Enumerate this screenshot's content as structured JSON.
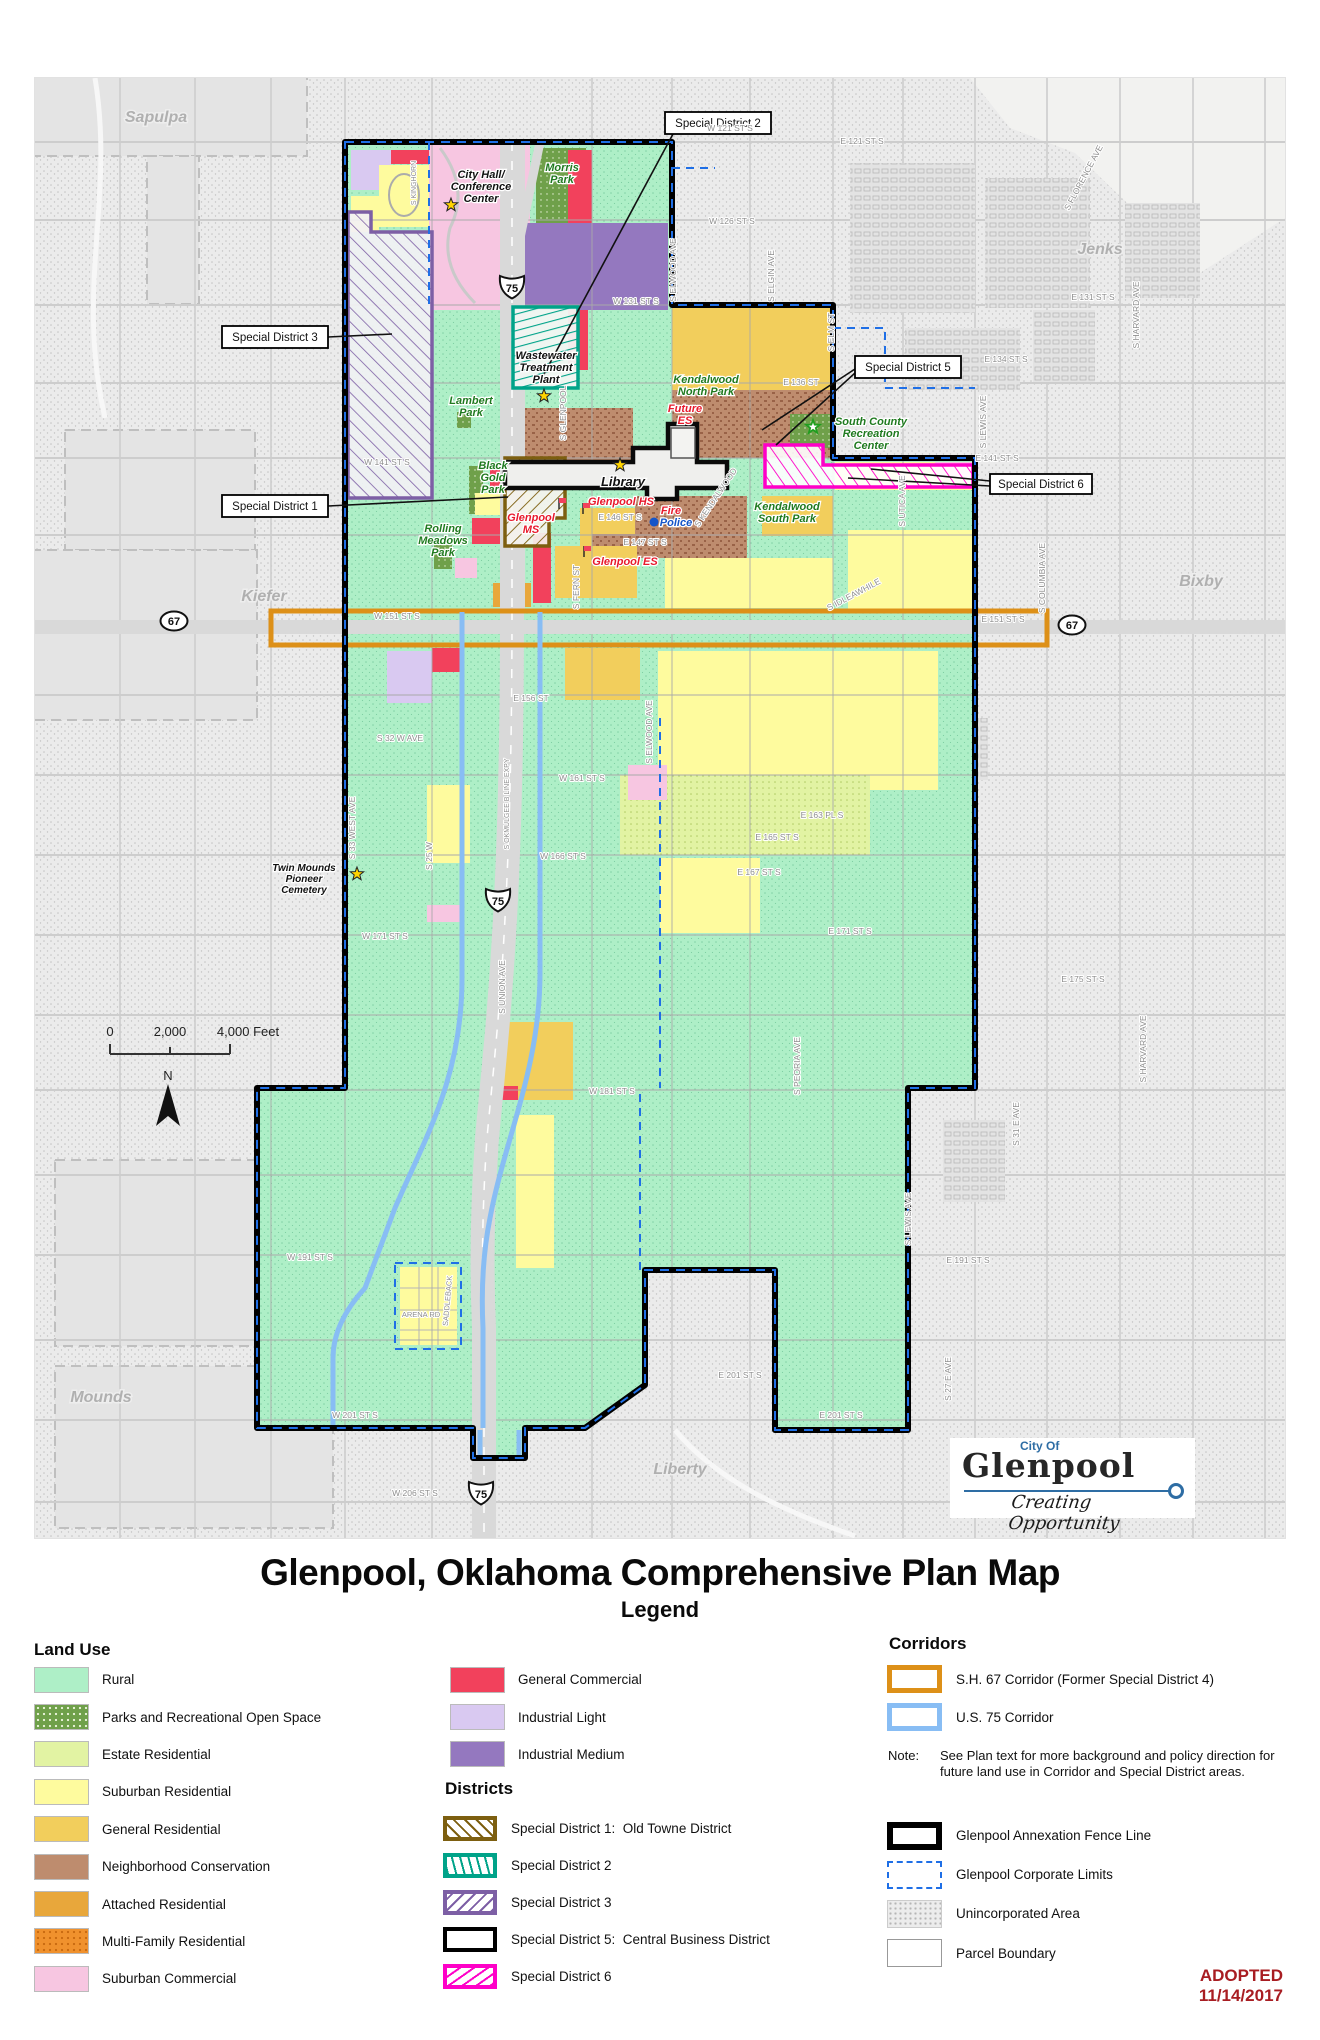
{
  "title": "Glenpool, Oklahoma Comprehensive Plan Map",
  "legend_title": "Legend",
  "adopted": {
    "line1": "ADOPTED",
    "line2": "11/14/2017"
  },
  "logo": {
    "city_of": "City Of",
    "name": "Glenpool",
    "tagline": "Creating Opportunity"
  },
  "palette": {
    "mint": "#aeefc7",
    "mintdot": "#7ecfa3",
    "parks": "#6fa04a",
    "estate": "#e2f3a3",
    "estatedot": "#aec962",
    "subres": "#fefb9e",
    "genres": "#f2ce5c",
    "nconv": "#be8c6e",
    "nconvdot": "#996247",
    "attres": "#e8a73b",
    "multi": "#f0912d",
    "subcom": "#f7c6e1",
    "gencom": "#f2415c",
    "indl": "#d9c9f1",
    "indm": "#9478bf",
    "c67": "#dd9018",
    "c75": "#88bdf4",
    "corp": "#1f6fe6",
    "sd1": "#7d5f10",
    "sd2": "#00a389",
    "sd3": "#7d5fa5",
    "sd6": "#ff00c8",
    "graybg": "#ebebeb",
    "stip": "#c2c2c2",
    "plain": "#e4e4e4",
    "road": "#d9d9d9",
    "parktext": "#1f7a1f",
    "schooltext": "#e8192c",
    "policeblue": "#1555c8",
    "adopted": "#a81d22",
    "star": "#ffd400",
    "greenstar": "#1f9e1f",
    "logoblue": "#2e6da4"
  },
  "legend": {
    "land_use": {
      "heading": "Land Use",
      "items": [
        {
          "label": "Rural",
          "color": "#aeefc7"
        },
        {
          "label": "Parks and Recreational Open Space",
          "color": "#6fa04a",
          "dots": "#e8f2d8"
        },
        {
          "label": "Estate Residential",
          "color": "#e2f3a3"
        },
        {
          "label": "Suburban Residential",
          "color": "#fefb9e"
        },
        {
          "label": "General Residential",
          "color": "#f2ce5c"
        },
        {
          "label": "Neighborhood Conservation",
          "color": "#be8c6e"
        },
        {
          "label": "Attached Residential",
          "color": "#e8a73b"
        },
        {
          "label": "Multi-Family Residential",
          "color": "#f0912d",
          "dots": "#c96a10"
        },
        {
          "label": "Suburban Commercial",
          "color": "#f7c6e1"
        }
      ]
    },
    "col2": [
      {
        "label": "General Commercial",
        "color": "#f2415c"
      },
      {
        "label": "Industrial Light",
        "color": "#d9c9f1"
      },
      {
        "label": "Industrial Medium",
        "color": "#9478bf"
      }
    ],
    "districts": {
      "heading": "Districts",
      "items": [
        {
          "label": "Special District 1:  Old Towne District",
          "color": "#7d5f10",
          "angle": 45
        },
        {
          "label": "Special District 2",
          "color": "#00a389",
          "angle": 75
        },
        {
          "label": "Special District 3",
          "color": "#7d5fa5",
          "angle": -45
        },
        {
          "label": "Special District 5:  Central Business District",
          "color": "#000000",
          "angle": null
        },
        {
          "label": "Special District 6",
          "color": "#ff00c8",
          "angle": -35
        }
      ]
    },
    "corridors": {
      "heading": "Corridors",
      "items": [
        {
          "label": "S.H. 67 Corridor (Former Special District 4)",
          "color": "#dd9018"
        },
        {
          "label": "U.S. 75 Corridor",
          "color": "#88bdf4"
        }
      ]
    },
    "note": {
      "label": "Note:",
      "text": "See Plan text for more background and policy direction for future land use in Corridor and Special District areas."
    },
    "boundaries": [
      {
        "label": "Glenpool Annexation Fence Line",
        "kind": "annex"
      },
      {
        "label": "Glenpool Corporate Limits",
        "kind": "corp"
      },
      {
        "label": "Unincorporated Area",
        "kind": "uninc"
      },
      {
        "label": "Parcel Boundary",
        "kind": "parcel"
      }
    ]
  },
  "map": {
    "cities": [
      {
        "t": "Sapulpa",
        "x": 121,
        "y": 44
      },
      {
        "t": "Jenks",
        "x": 1065,
        "y": 176
      },
      {
        "t": "Bixby",
        "x": 1166,
        "y": 508
      },
      {
        "t": "Kiefer",
        "x": 229,
        "y": 523
      },
      {
        "t": "Mounds",
        "x": 66,
        "y": 1324
      },
      {
        "t": "Liberty",
        "x": 645,
        "y": 1396
      }
    ],
    "streets": [
      {
        "t": "W 121 ST S",
        "x": 695,
        "y": 53
      },
      {
        "t": "E 121 ST S",
        "x": 827,
        "y": 66
      },
      {
        "t": "W 126 ST S",
        "x": 697,
        "y": 146
      },
      {
        "t": "W 131 ST S",
        "x": 601,
        "y": 226
      },
      {
        "t": "E 131 ST S",
        "x": 1058,
        "y": 222
      },
      {
        "t": "E 134 ST S",
        "x": 971,
        "y": 284
      },
      {
        "t": "E 136 ST",
        "x": 766,
        "y": 307
      },
      {
        "t": "W 141 ST S",
        "x": 352,
        "y": 387
      },
      {
        "t": "E 141 ST S",
        "x": 962,
        "y": 383
      },
      {
        "t": "E 146 ST S",
        "x": 585,
        "y": 442
      },
      {
        "t": "E 147 ST S",
        "x": 610,
        "y": 467
      },
      {
        "t": "W 151 ST S",
        "x": 362,
        "y": 541
      },
      {
        "t": "E 151 ST S",
        "x": 968,
        "y": 544
      },
      {
        "t": "E 156 ST",
        "x": 496,
        "y": 623
      },
      {
        "t": "W 161 ST S",
        "x": 547,
        "y": 703
      },
      {
        "t": "E 163 PL S",
        "x": 787,
        "y": 740
      },
      {
        "t": "E 165 ST S",
        "x": 742,
        "y": 762
      },
      {
        "t": "W 166 ST S",
        "x": 528,
        "y": 781
      },
      {
        "t": "E 167 ST S",
        "x": 724,
        "y": 797
      },
      {
        "t": "W 171 ST S",
        "x": 350,
        "y": 861
      },
      {
        "t": "E 171 ST S",
        "x": 815,
        "y": 856
      },
      {
        "t": "E 175 ST S",
        "x": 1048,
        "y": 904
      },
      {
        "t": "W 181 ST S",
        "x": 577,
        "y": 1016
      },
      {
        "t": "E 191 ST S",
        "x": 933,
        "y": 1185
      },
      {
        "t": "W 191 ST S",
        "x": 275,
        "y": 1182
      },
      {
        "t": "W 201 ST S",
        "x": 320,
        "y": 1340
      },
      {
        "t": "E 201 ST S",
        "x": 705,
        "y": 1300
      },
      {
        "t": "E 201 ST S",
        "x": 806,
        "y": 1340
      },
      {
        "t": "W 206 ST S",
        "x": 380,
        "y": 1418
      },
      {
        "t": "S 32 W AVE",
        "x": 365,
        "y": 663
      },
      {
        "t": "S 33 WEST AVE",
        "x": 320,
        "y": 750,
        "r": -90
      },
      {
        "t": "S 25 W",
        "x": 397,
        "y": 778,
        "r": -90
      },
      {
        "t": "S OKMULGEE B LINE EXPY",
        "x": 474,
        "y": 726,
        "r": -90,
        "s": 7
      },
      {
        "t": "S UNION AVE",
        "x": 470,
        "y": 909,
        "r": -90
      },
      {
        "t": "S ELWOOD AVE",
        "x": 617,
        "y": 654,
        "r": -90
      },
      {
        "t": "S ELWOOD AVE",
        "x": 641,
        "y": 192,
        "r": -90
      },
      {
        "t": "S FERN ST",
        "x": 544,
        "y": 509,
        "r": -90
      },
      {
        "t": "S GLENPOOL",
        "x": 531,
        "y": 335,
        "r": -90
      },
      {
        "t": "S PEORIA AVE",
        "x": 765,
        "y": 988,
        "r": -90
      },
      {
        "t": "S ELGIN AVE",
        "x": 739,
        "y": 198,
        "r": -90
      },
      {
        "t": "S ELM ST",
        "x": 799,
        "y": 254,
        "r": -90
      },
      {
        "t": "S LEWIS AVE",
        "x": 951,
        "y": 344,
        "r": -90
      },
      {
        "t": "S LEWIS AVE",
        "x": 876,
        "y": 1141,
        "r": -90
      },
      {
        "t": "S UTICA AVE",
        "x": 870,
        "y": 423,
        "r": -90
      },
      {
        "t": "S COLUMBIA AVE",
        "x": 1010,
        "y": 500,
        "r": -90
      },
      {
        "t": "S HARVARD AVE",
        "x": 1104,
        "y": 237,
        "r": -90
      },
      {
        "t": "S HARVARD AVE",
        "x": 1111,
        "y": 971,
        "r": -90
      },
      {
        "t": "S 31 E AVE",
        "x": 984,
        "y": 1046,
        "r": -90
      },
      {
        "t": "S 27 E AVE",
        "x": 916,
        "y": 1301,
        "r": -90
      },
      {
        "t": "S KINGHORN",
        "x": 381,
        "y": 105,
        "r": -90,
        "s": 7
      },
      {
        "t": "S FLORENCE AVE",
        "x": 1051,
        "y": 101,
        "r": -62
      },
      {
        "t": "S KENDALWOOD",
        "x": 683,
        "y": 421,
        "r": -56
      },
      {
        "t": "S IDLEAWHILE",
        "x": 820,
        "y": 519,
        "r": -28
      },
      {
        "t": "SADDLEBACK",
        "x": 415,
        "y": 1223,
        "r": -85,
        "s": 7.5
      },
      {
        "t": "ARENA RD",
        "x": 386,
        "y": 1239,
        "s": 7.5
      }
    ],
    "places": [
      {
        "lines": [
          "City Hall/",
          "Conference",
          "Center"
        ],
        "x": 446,
        "y": 100,
        "cls": "civic-lbl"
      },
      {
        "lines": [
          "Morris",
          "Park"
        ],
        "x": 527,
        "y": 93,
        "cls": "park-lbl"
      },
      {
        "lines": [
          "Wastewater",
          "Treatment",
          "Plant"
        ],
        "x": 511,
        "y": 281,
        "cls": "civic-lbl"
      },
      {
        "lines": [
          "Lambert",
          "Park"
        ],
        "x": 436,
        "y": 326,
        "cls": "park-lbl"
      },
      {
        "lines": [
          "Kendalwood",
          "North Park"
        ],
        "x": 671,
        "y": 305,
        "cls": "park-lbl"
      },
      {
        "lines": [
          "Future",
          "ES"
        ],
        "x": 650,
        "y": 334,
        "cls": "school-lbl"
      },
      {
        "lines": [
          "South County",
          "Recreation",
          "Center"
        ],
        "x": 836,
        "y": 347,
        "cls": "park-lbl"
      },
      {
        "lines": [
          "Black",
          "Gold",
          "Park"
        ],
        "x": 458,
        "y": 391,
        "cls": "park-lbl"
      },
      {
        "lines": [
          "Library"
        ],
        "x": 588,
        "y": 408,
        "cls": "civic-lbl",
        "s": 13
      },
      {
        "lines": [
          "Glenpool HS"
        ],
        "x": 586,
        "y": 427,
        "cls": "school-lbl"
      },
      {
        "lines": [
          "Glenpool",
          "MS"
        ],
        "x": 496,
        "y": 443,
        "cls": "school-lbl"
      },
      {
        "lines": [
          "Fire"
        ],
        "x": 636,
        "y": 436,
        "cls": "school-lbl"
      },
      {
        "lines": [
          "Police"
        ],
        "x": 641,
        "y": 448,
        "cls": "police-lbl"
      },
      {
        "lines": [
          "Kendalwood",
          "South Park"
        ],
        "x": 752,
        "y": 432,
        "cls": "park-lbl"
      },
      {
        "lines": [
          "Glenpool ES"
        ],
        "x": 590,
        "y": 487,
        "cls": "school-lbl"
      },
      {
        "lines": [
          "Rolling",
          "Meadows",
          "Park"
        ],
        "x": 408,
        "y": 454,
        "cls": "park-lbl"
      },
      {
        "lines": [
          "Twin Mounds",
          "Pioneer",
          "Cemetery"
        ],
        "x": 269,
        "y": 793,
        "cls": "civic-lbl",
        "s": 10
      }
    ],
    "stars": [
      {
        "x": 416,
        "y": 127,
        "c": "y"
      },
      {
        "x": 509,
        "y": 318,
        "c": "y"
      },
      {
        "x": 585,
        "y": 387,
        "c": "y"
      },
      {
        "x": 322,
        "y": 796,
        "c": "y"
      },
      {
        "x": 778,
        "y": 349,
        "c": "g"
      }
    ],
    "flags": [
      {
        "x": 524,
        "y": 431
      },
      {
        "x": 548,
        "y": 436
      },
      {
        "x": 549,
        "y": 479
      }
    ],
    "callouts": [
      {
        "label": "Special District 2",
        "x": 630,
        "y": 34,
        "w": 106
      },
      {
        "label": "Special District 3",
        "x": 187,
        "y": 248,
        "w": 106
      },
      {
        "label": "Special District 1",
        "x": 187,
        "y": 417,
        "w": 106
      },
      {
        "label": "Special District 5",
        "x": 820,
        "y": 278,
        "w": 106
      },
      {
        "label": "Special District 6",
        "x": 955,
        "y": 396,
        "w": 102
      }
    ],
    "shields": [
      {
        "k": "us",
        "n": "75",
        "x": 477,
        "y": 207
      },
      {
        "k": "us",
        "n": "75",
        "x": 463,
        "y": 820
      },
      {
        "k": "us",
        "n": "75",
        "x": 446,
        "y": 1413
      },
      {
        "k": "oval",
        "n": "67",
        "x": 139,
        "y": 543
      },
      {
        "k": "oval",
        "n": "67",
        "x": 1037,
        "y": 547
      }
    ],
    "scale": {
      "t0": "0",
      "t2": "2,000",
      "t4": "4,000 Feet",
      "n": "N"
    }
  }
}
